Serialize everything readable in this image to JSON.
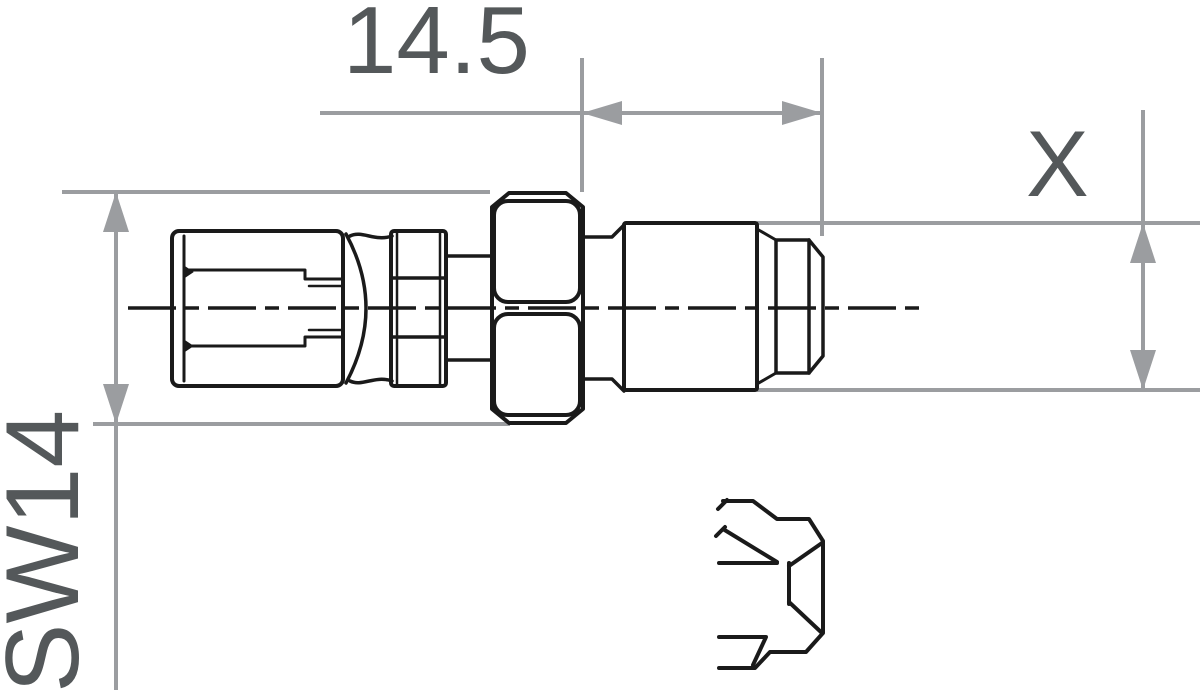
{
  "drawing": {
    "type": "technical-dimension-drawing",
    "subject": "brake hose fitting, side view with partial hex end detail view",
    "labels": {
      "length": "14.5",
      "thread_diameter": "X",
      "hex_width": "SW14"
    },
    "dimensions": [
      {
        "id": "length",
        "value": "14.5",
        "measures": "distance from hex nut face to thread tip",
        "orientation": "horizontal"
      },
      {
        "id": "thread_diameter",
        "value": "X",
        "measures": "outer diameter of threaded body",
        "orientation": "vertical"
      },
      {
        "id": "hex_width",
        "value": "SW14",
        "measures": "hex nut width across flats",
        "orientation": "vertical"
      }
    ],
    "colors": {
      "part_line": "#1a1a1a",
      "dimension_line": "#9b9da0",
      "label_text": "#54585a",
      "background": "#ffffff"
    }
  }
}
